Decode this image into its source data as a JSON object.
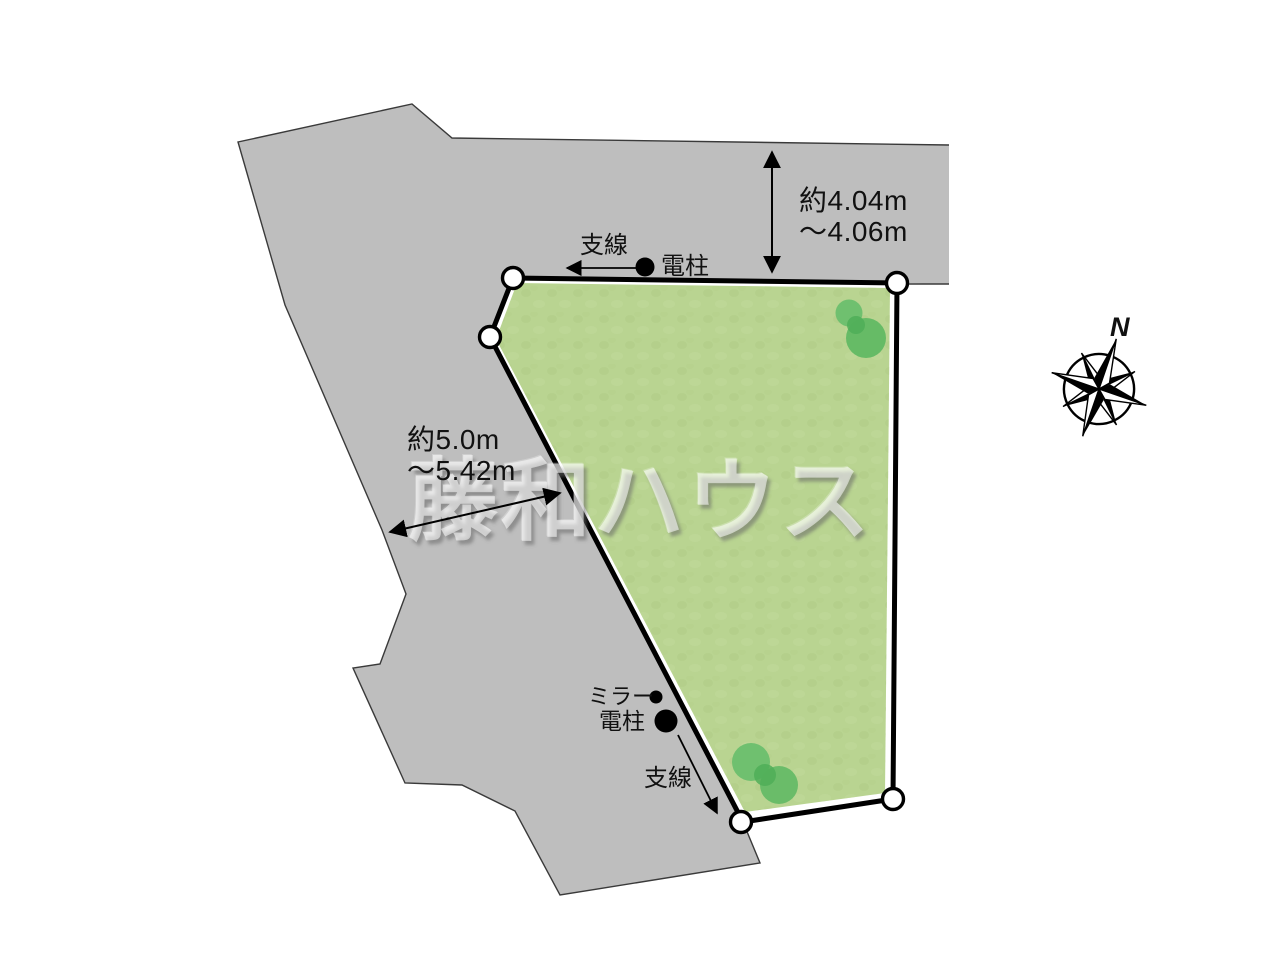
{
  "diagram_type": "land-plot-layout",
  "labels": {
    "guy_wire_top": "支線",
    "utility_pole_top": "電柱",
    "mirror": "ミラー",
    "utility_pole_bottom": "電柱",
    "guy_wire_bottom": "支線"
  },
  "dimensions": {
    "north_side": {
      "line1": "約4.04m",
      "line2": "〜4.06m"
    },
    "west_side": {
      "line1": "約5.0m",
      "line2": "〜5.42m"
    }
  },
  "compass": {
    "label": "N"
  },
  "watermark": "藤和ハウス",
  "colors": {
    "road": "#bebebe",
    "road_outline": "#3a3a3a",
    "plot_green": "#b9d491",
    "plot_green_texture": "#aecb83",
    "plot_border": "#000000",
    "tree_light": "#6fc06f",
    "tree_dark": "#4fae58",
    "marker_fill": "#ffffff",
    "annotation": "#000000"
  }
}
